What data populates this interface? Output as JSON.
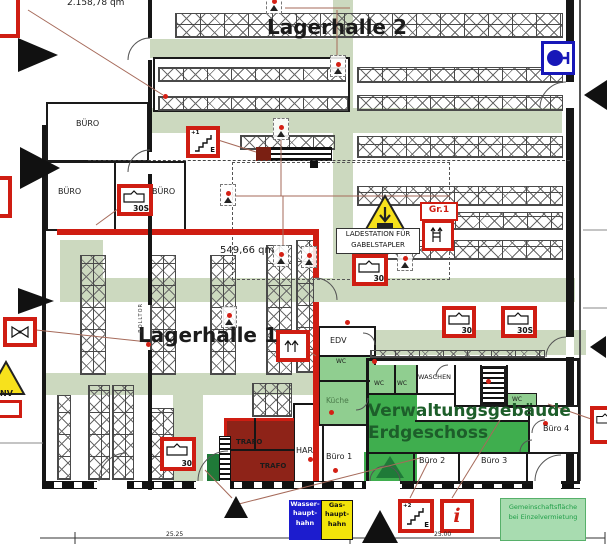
{
  "titles": {
    "lagerhalle2": "Lagerhalle 2",
    "lagerhalle1": "Lagerhalle 1",
    "verwaltung1": "Verwaltungsgebäude",
    "verwaltung2": "Erdgeschoss"
  },
  "areas": {
    "lagerhalle2": "2.158,78 qm",
    "lagerhalle1": "549,66 qm"
  },
  "rooms": {
    "buero": "BÜRO",
    "edv": "EDV",
    "wc": "WC",
    "waschen": "WASCHEN",
    "kueche": "Küche",
    "har": "HAR",
    "trafo": "TRAFO",
    "buero1": "Büro 1",
    "buero2": "Büro 2",
    "buero3": "Büro 3",
    "buero4": "Büro 4",
    "rolltor": "ROLLTOR"
  },
  "icons": {
    "t30": "30",
    "t30s": "30S",
    "gr1": "Gr.1",
    "info": "i",
    "stairs_up1": "+1",
    "stairs_up2": "+2",
    "stairs_exit": "E"
  },
  "warnings": {
    "ladestation1": "LADESTATION FÜR",
    "ladestation2": "GABELSTAPLER",
    "nv": "NV"
  },
  "signs": {
    "wasser": [
      "Wasser-",
      "haupt-",
      "hahn"
    ],
    "gas": [
      "Gas-",
      "haupt-",
      "hahn"
    ],
    "gemeinschaft1": "Gemeinschaftsfläche",
    "gemeinschaft2": "bei Einzelvermietung"
  },
  "dimensions": {
    "left": "25.25",
    "right": "25.00"
  },
  "colors": {
    "escape_route": "#ccd9bf",
    "corridor_green": "#3fae4e",
    "room_green": "#90ce90",
    "stair_green": "#1f7a38",
    "fire_red": "#cf1d12",
    "trafo_fill": "#8e2318",
    "hydrant_blue": "#1717b8",
    "sign_blue": "#1c1cce",
    "sign_yellow": "#f3e50a",
    "warning_yellow": "#f7e11c",
    "title_green": "#1d5e2a"
  }
}
